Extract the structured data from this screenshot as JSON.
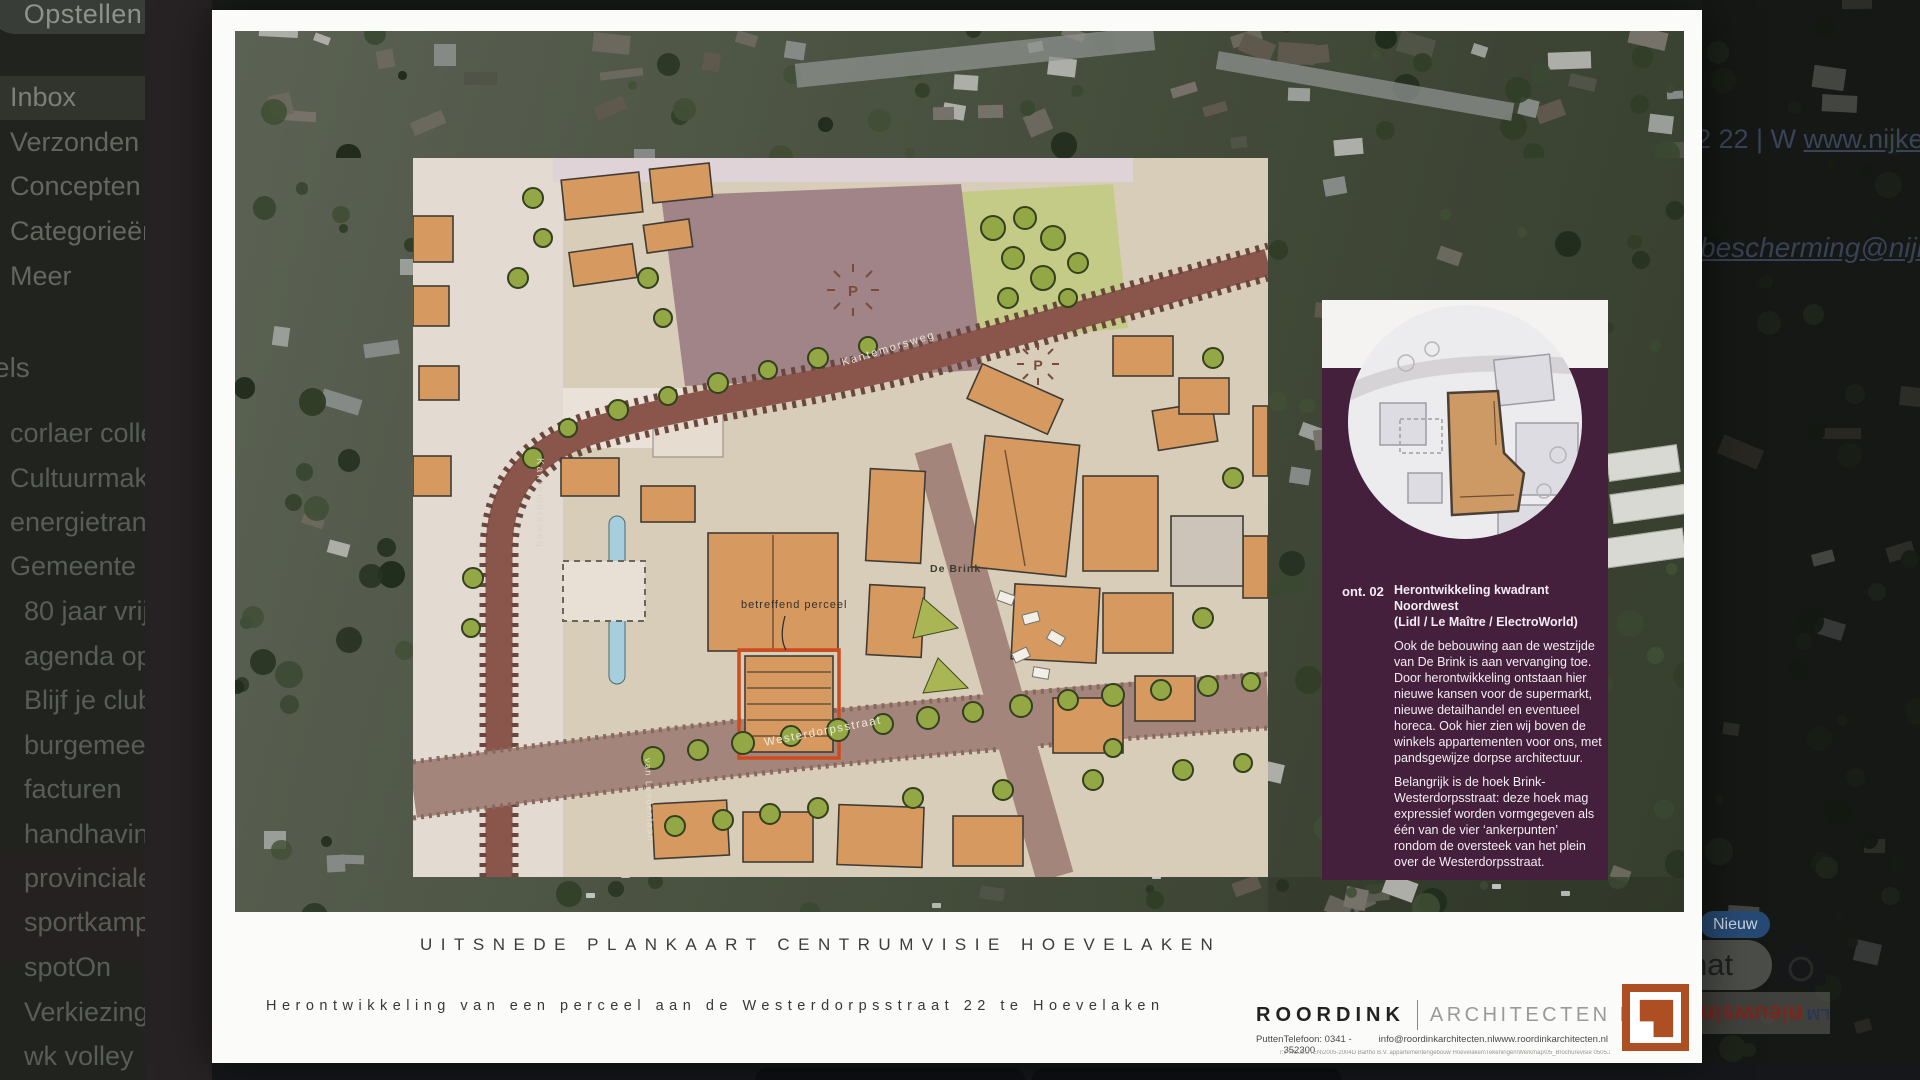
{
  "email_app": {
    "compose_label": "Opstellen",
    "nav": [
      "Inbox",
      "Verzonden",
      "Concepten",
      "Categorieën",
      "Meer"
    ],
    "labels_header": "els",
    "labels": [
      "corlaer college",
      "Cultuurmakelaars",
      "energietransitie",
      "Gemeente",
      "80 jaar vrijheid",
      "agenda op nn",
      "Blijf je club trou",
      "burgemeester",
      "facturen",
      "handhaving",
      "provinciale state",
      "sportkampioene",
      "spotOn",
      "Verkiezingen",
      "wk volley"
    ],
    "header_fragment": "2 22 | W ",
    "header_link": "www.nijkerk",
    "email_link_fragment": "sbescherming@nijke",
    "new_badge": "Nieuw",
    "chat_fragment": "hat",
    "flipped_logo_fragment_red": "nieuwsin",
    "flipped_logo_fragment_blue": "LM"
  },
  "viewer": {
    "plan": {
      "street_diagonal": "Kantemorsweg",
      "street_vertical_left": "Kantemorsweg",
      "street_vertical_mid": "van Lyndenlaan",
      "square_label": "De Brink",
      "parcel_label": "betreffend perceel",
      "street_bottom": "Westerdorpsstraat",
      "parking_symbol_1": "P",
      "parking_symbol_2": "P",
      "parcel_outline_color": "#cf4b1c"
    },
    "info_panel": {
      "ref": "ont. 02",
      "title": "Herontwikkeling kwadrant Noordwest",
      "subtitle": "(Lidl / Le Maître / ElectroWorld)",
      "body1": "Ook de bebouwing aan de westzijde van De Brink is aan vervanging toe. Door herontwikkeling ontstaan hier nieuwe kansen voor de supermarkt, nieuwe detailhandel en eventueel horeca. Ook hier zien wij boven de winkels appartementen voor ons, met pandsgewijze dorpse architectuur.",
      "body2": "Belangrijk is de hoek Brink-Westerdorpsstraat: deze hoek mag expressief worden vormgegeven als één van de vier ‘ankerpunten’ rondom de oversteek van het plein over de Westerdorpsstraat.",
      "panel_color": "#44203d"
    },
    "caption_title": "UITSNEDE PLANKAART CENTRUMVISIE HOEVELAKEN",
    "caption_subtitle": "Herontwikkeling van een perceel aan de Westerdorpsstraat 22 te Hoevelaken",
    "firm": {
      "name": "ROORDINK",
      "suffix": "ARCHITECTEN BNA",
      "city": "Putten",
      "phone": "Telefoon: 0341 - 352300",
      "email": "info@roordinkarchitecten.nl",
      "site": "www.roordinkarchitecten.nl",
      "fineprint": "I:\\PROJECTEN\\2005-2004D Bartho B.V. appartementengebouw Hoevelaken\\Tekeningen\\Werkmap\\05_Brochurevisie 0505.20B43_uitsnijden_v7.plt",
      "logo_color": "#ae4f23"
    }
  }
}
